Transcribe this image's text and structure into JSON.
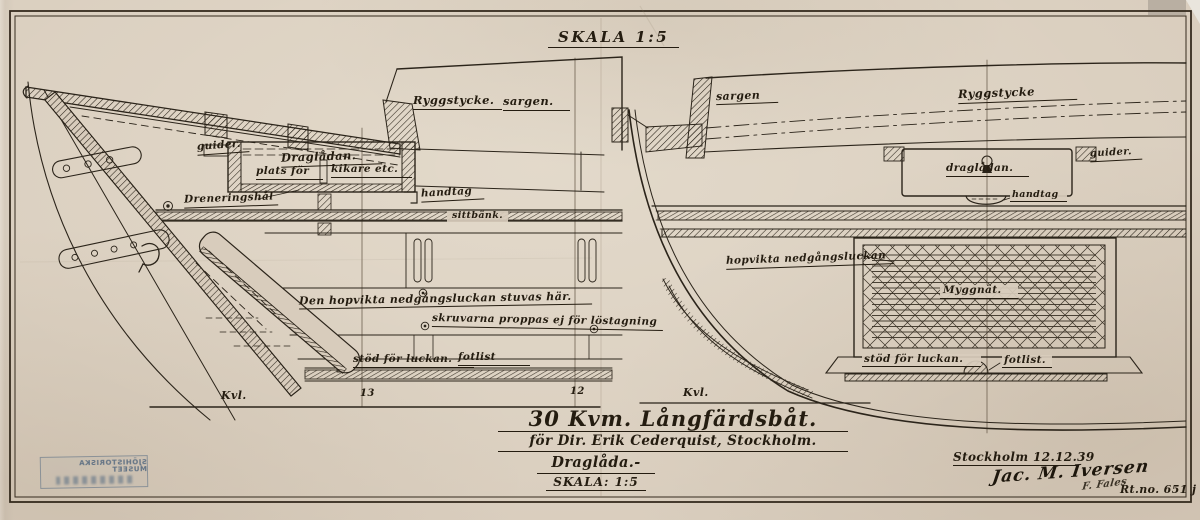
{
  "header": {
    "skala": "SKALA 1:5"
  },
  "left": {
    "ryggstycke": "Ryggstycke.",
    "sargen": "sargen.",
    "guider": "guider.",
    "dragladan": "Draglådan.",
    "plats_for": "plats för",
    "kikare": "kikare etc.",
    "handtag": "handtag",
    "draneringshal": "Dreneringshål",
    "sittbank": "sittbänk.",
    "stuvas": "Den hopvikta nedgångsluckan stuvas här.",
    "skruvarna": "skruvarna proppas ej för löstagning",
    "stod": "stöd för luckan.",
    "fotlist": "fotlist",
    "kvl": "Kvl.",
    "station13": "13",
    "station12": "12"
  },
  "right": {
    "sargen": "sargen",
    "ryggstycke": "Ryggstycke",
    "guider": "guider.",
    "dragladan": "draglådan.",
    "handtag": "handtag",
    "lucka": "hopvikta nedgångsluckan",
    "myggnat": "Myggnät.",
    "stod": "stöd för luckan.",
    "fotlist": "fotlist.",
    "kvl": "Kvl."
  },
  "title_block": {
    "line1": "30 Kvm. Långfärdsbåt.",
    "line2": "för Dir. Erik Cederquist, Stockholm.",
    "line3": "Draglåda.-",
    "line4": "SKALA: 1:5",
    "place_date": "Stockholm 12.12.39",
    "signature": "Jac. M. Iversen",
    "checker": "F. Fales",
    "drawing_no": "Rt.no. 651 j"
  },
  "stamp": {
    "line1": "SJÖHISTORISKA MUSEET",
    "mirrored": true
  },
  "colors": {
    "paper": "#d8ccbc",
    "ink": "#2b241a",
    "stamp": "#56708a"
  }
}
